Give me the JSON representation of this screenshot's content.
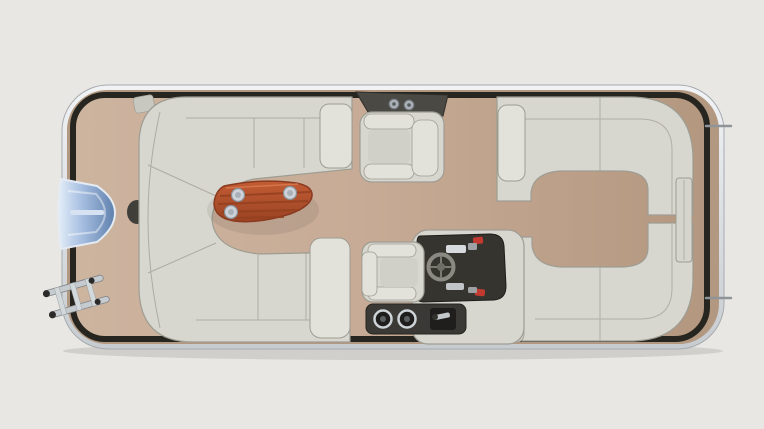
{
  "figure": {
    "subject": "pontoon-boat-floorplan-top-down-render",
    "orientation": "bow-left-stern-right",
    "parts": [
      "bow boarding gate",
      "boarding ladder",
      "wraparound bow lounge",
      "cocktail table with cupholders",
      "side gate hinge bracket",
      "bow armchair",
      "port stern chaise lounge",
      "starboard stern chaise lounge",
      "helm console with steering wheel",
      "captain chair",
      "helm base speakers and throttle",
      "stern gate",
      "stern tow rods"
    ]
  },
  "colors": {
    "background": "#e9e7e3",
    "hull_light": "#f1f3f5",
    "hull_dark": "#c7ccd0",
    "hull_stroke": "#a6abb0",
    "deck_margin": "#b29880",
    "fence": "#26251f",
    "deck_left": "#cdb49f",
    "deck_mid": "#c7ab96",
    "deck_right": "#b3977f",
    "seat": "#d8d7cf",
    "seat_light": "#e2e1da",
    "seat_stroke": "#9e9d93",
    "seat_seam": "#96958b",
    "cushion_inner": "#d1d0c8",
    "table_light": "#c35c34",
    "table_dark": "#9a4323",
    "table_slat": "#93401f",
    "table_stroke": "#8a3a20",
    "cupholder_ring": "#cdd2d8",
    "cupholder_core": "#a9b0b8",
    "gate_light": "#e3edf8",
    "gate_mid": "#a8c0e2",
    "gate_dark": "#5f80ac",
    "console_dark": "#35342f",
    "wheel": "#8b8a82",
    "accent_red": "#c23a30",
    "chrome": "#c6cbcf",
    "dark_metal": "#3a3935",
    "bracket_metal": "#4a4944",
    "mount_dark": "#413f3a"
  }
}
